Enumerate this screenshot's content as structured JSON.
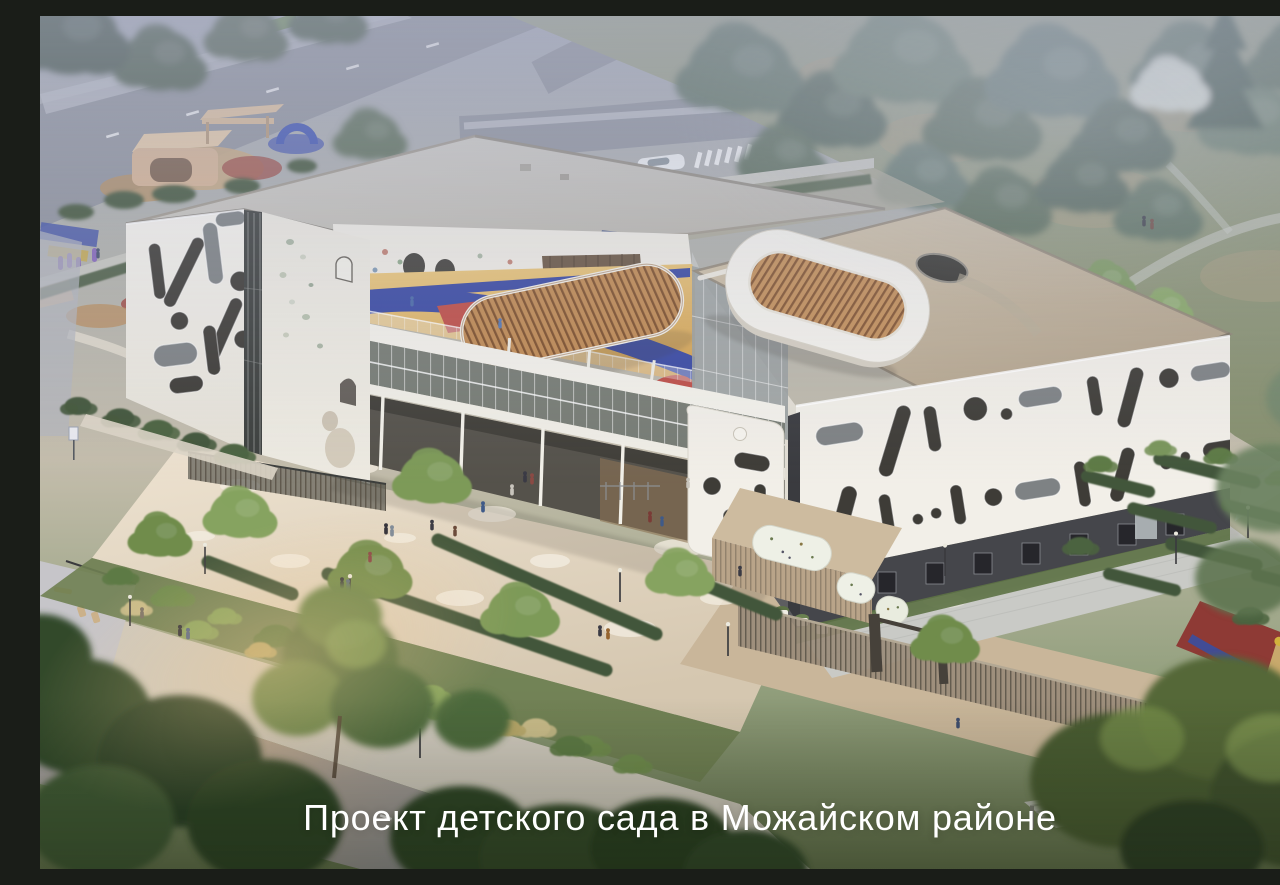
{
  "caption": {
    "text": "Проект детского сада в Можайском районе"
  },
  "colors": {
    "caption-text": "#ffffff",
    "building-white": "#f2efe8",
    "building-shade": "#e2ded4",
    "facade-cutout": "#3e3c37",
    "base-charcoal": "#45464b",
    "roof-gray": "#c6c3bc",
    "roof-beige": "#c7b89f",
    "rooftop-floor": "#dcab57",
    "track-blue": "#3a4aa3",
    "accent-red": "#bf4e47",
    "wood": "#c18a52",
    "hedge": "#42563a",
    "green-dark": "#3c5132",
    "green-mid": "#5d7a45",
    "green-light": "#8aa55e",
    "paving-warm": "#e3d8c5",
    "paving-cool": "#c9cac6",
    "road": "#8f939d",
    "fence-tan": "#9a8c79",
    "haze": "#a9aec4"
  }
}
